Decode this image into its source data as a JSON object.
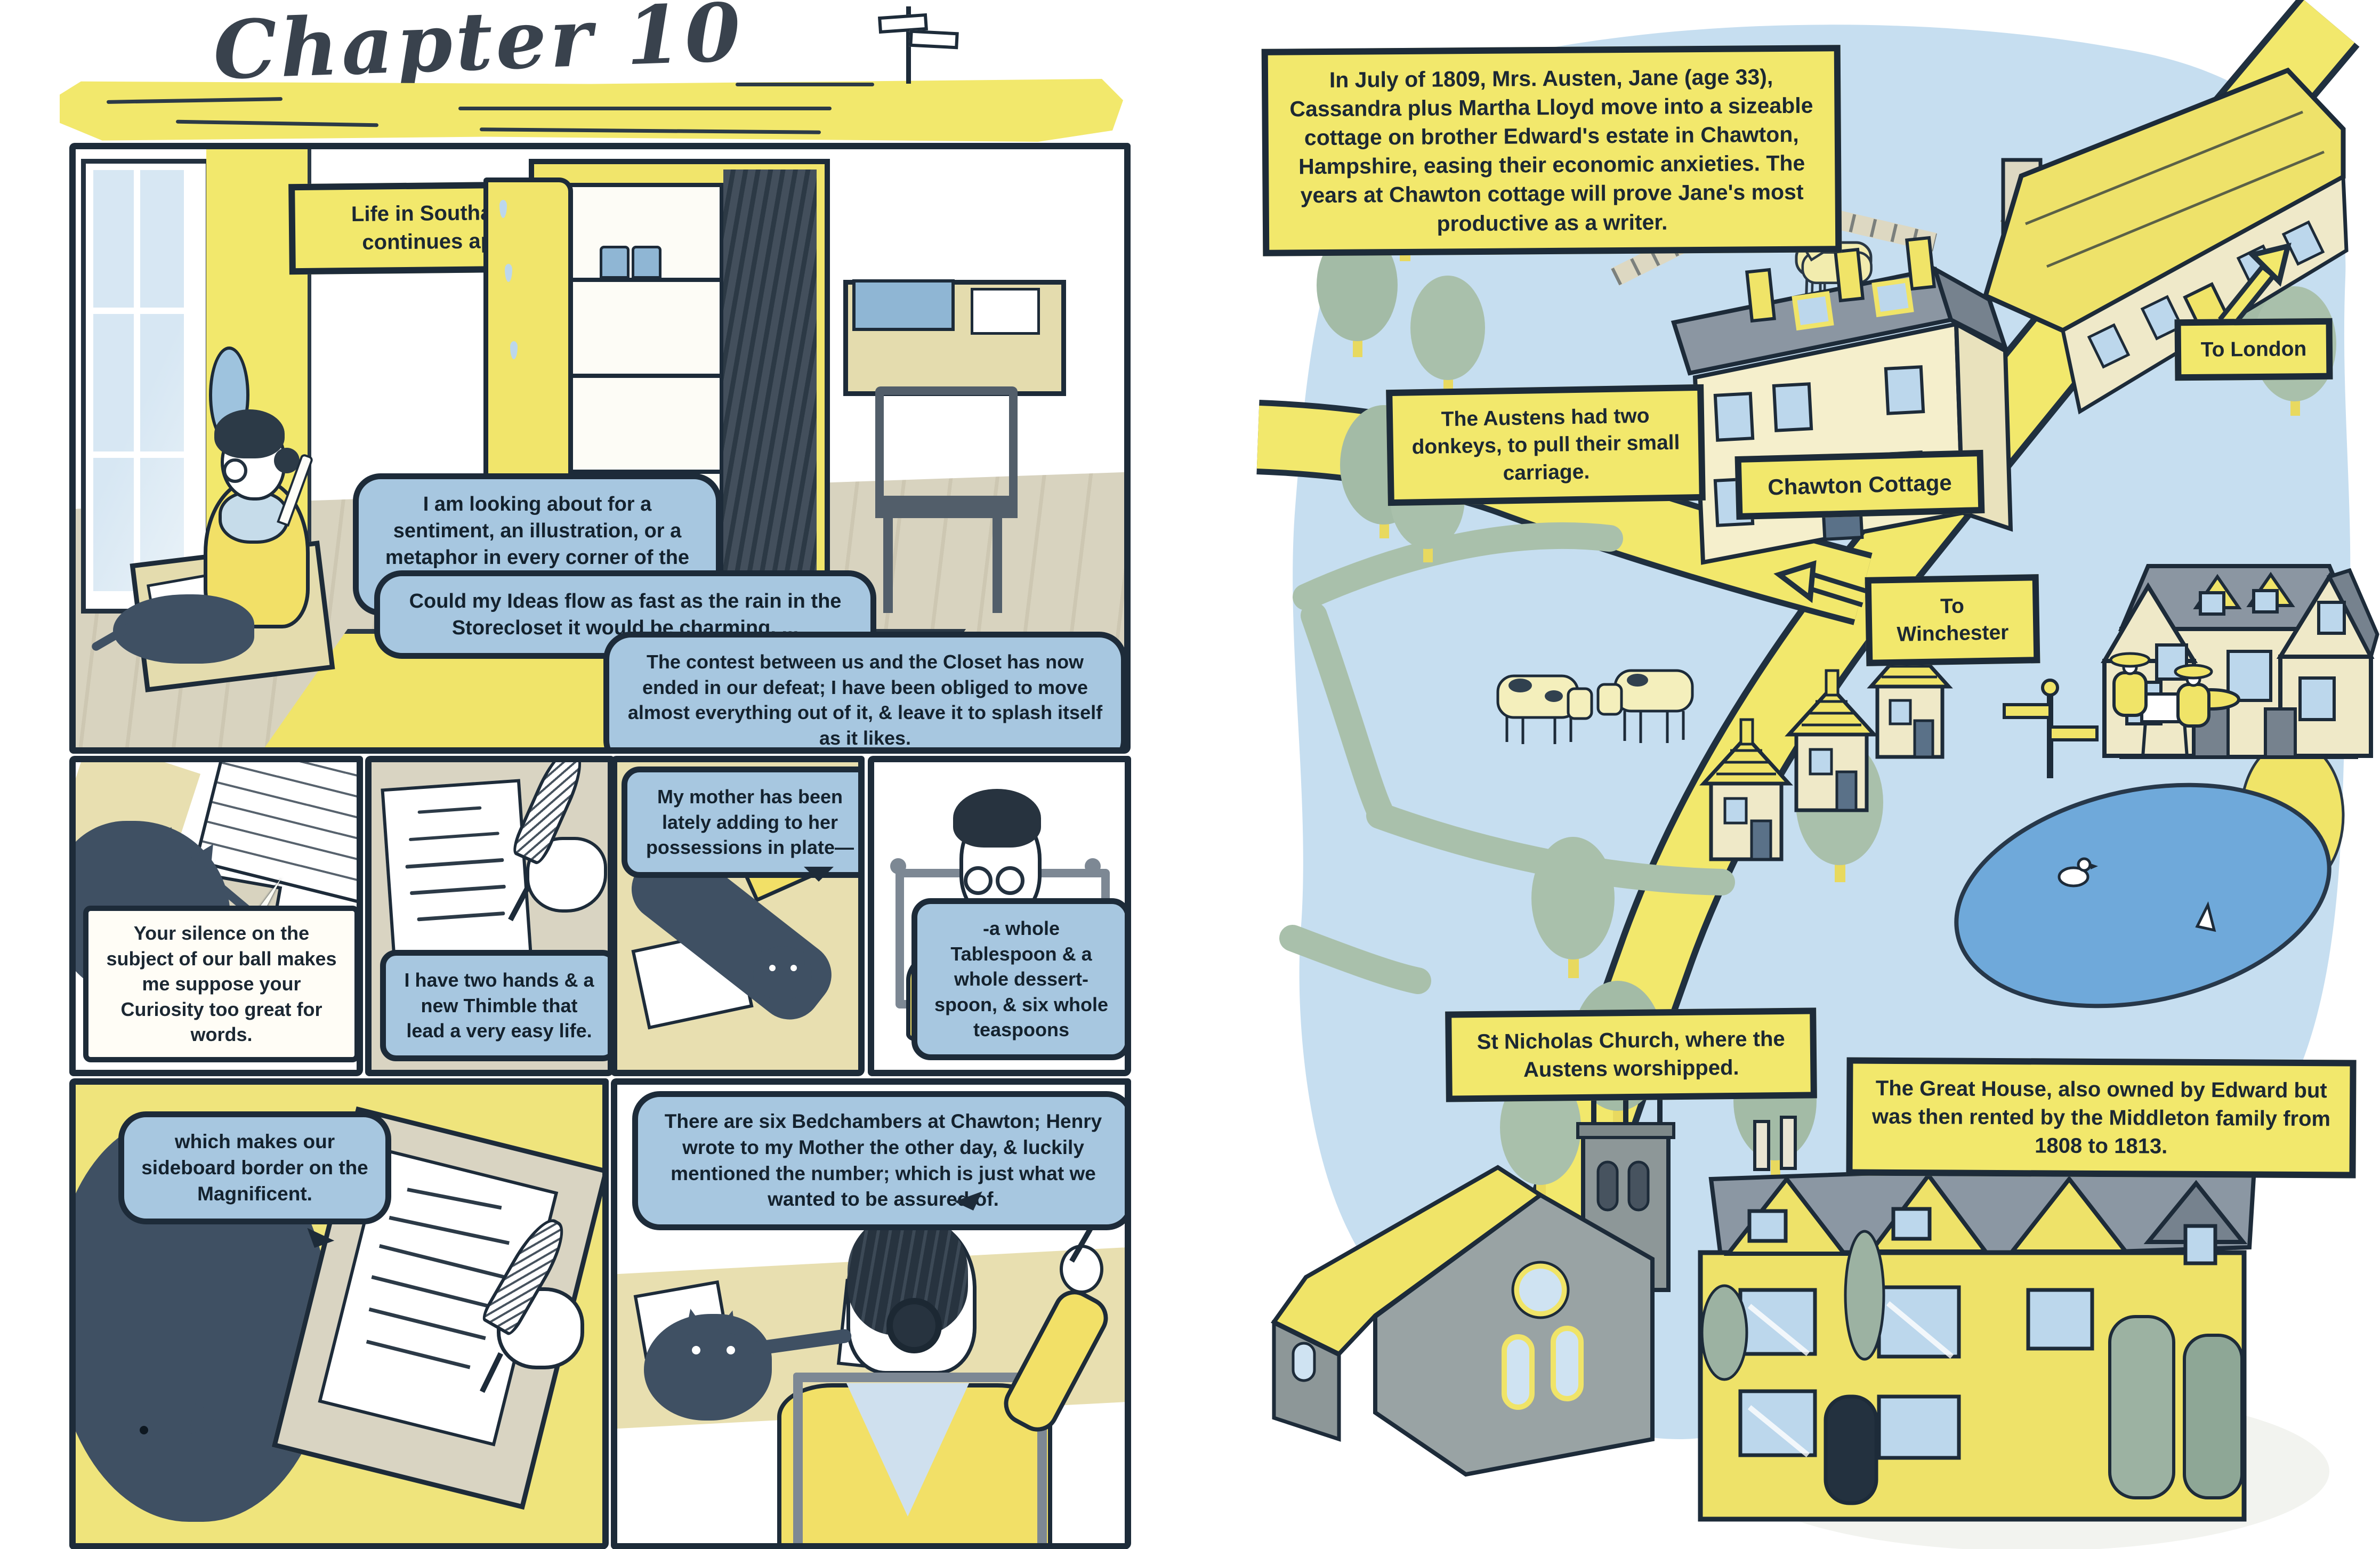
{
  "left": {
    "title": "Chapter 10",
    "p1": {
      "caption": "Life in Southampton continues apace...",
      "b1": "I am looking about for a sentiment, an illustration, or a metaphor in every corner of the room.",
      "b2": "Could my Ideas flow as fast as the rain in the Storecloset it would be charming. ...",
      "b3": "The contest between us and the Closet has now ended in our defeat; I have been obliged to move almost everything out of it, & leave it to splash itself as it likes."
    },
    "p2": {
      "caption": "Your silence on the subject of our ball makes me suppose your Curiosity too great for words."
    },
    "p3": {
      "bubble": "I have two hands & a new Thimble that lead a very easy life."
    },
    "p4": {
      "bubble": "My mother has been lately adding to her possessions in plate—"
    },
    "p5": {
      "bubble": "-a whole Tablespoon & a whole dessert-spoon, & six whole teaspoons"
    },
    "p6": {
      "bubble": "which makes our sideboard border on the Magnificent."
    },
    "p7": {
      "bubble": "There are six Bedchambers at Chawton; Henry wrote to my Mother the other day, & luckily mentioned the number; which is just what we wanted to be assured of."
    }
  },
  "right": {
    "intro": "In July of 1809, Mrs. Austen, Jane (age 33), Cassandra plus Martha Lloyd move into a sizeable cottage on brother Edward's estate in Chawton, Hampshire, easing their economic anxieties. The years at Chawton cottage will prove Jane's most productive as a writer.",
    "labels": {
      "donkeys": "The Austens had two donkeys, to pull their small carriage.",
      "cottage": "Chawton Cottage",
      "to_london": "To London",
      "to_winchester": "To Winchester",
      "church": "St Nicholas Church, where the Austens worshipped.",
      "great_house": "The Great House, also owned by Edward but was then rented by the Middleton family from 1808 to 1813."
    }
  },
  "colors": {
    "ink": "#1d2b39",
    "yellow": "#f2e86c",
    "bubble_blue": "#a7c7e0",
    "map_blue": "#c6def0",
    "pond_blue": "#6fa9da",
    "sage_green": "#a9c0ab",
    "cream": "#f3eecb",
    "roof_grey": "#8b96a2"
  }
}
